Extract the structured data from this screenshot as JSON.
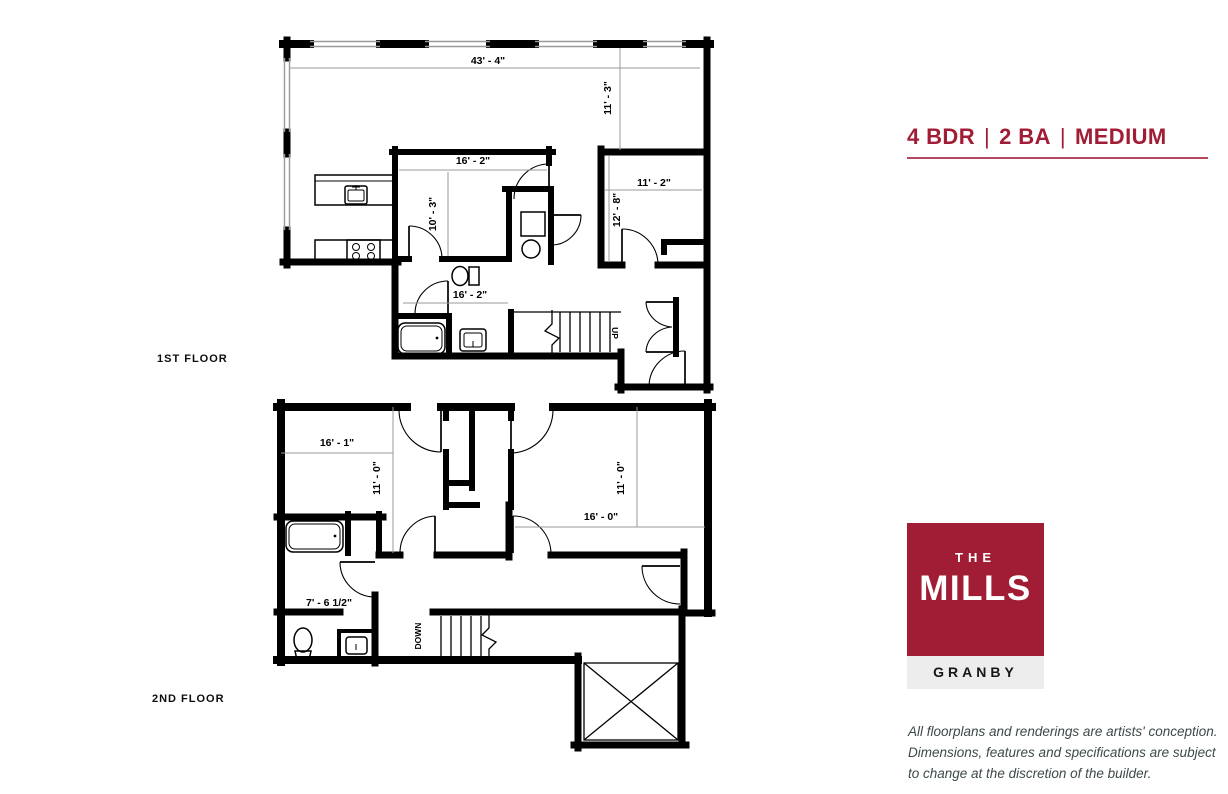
{
  "header": {
    "bedrooms": "4 BDR",
    "separator": "|",
    "baths": "2 BA",
    "size": "MEDIUM"
  },
  "floor_labels": {
    "first": "1ST FLOOR",
    "second": "2ND FLOOR"
  },
  "dims": {
    "f1": {
      "overall_width": "43' - 4\"",
      "living_depth": "11' - 3\"",
      "bedroom1_width": "16' - 2\"",
      "bedroom1_depth": "10' - 3\"",
      "bedroom2_width": "11' - 2\"",
      "bedroom2_depth": "12' - 8\"",
      "bath_width": "16' - 2\""
    },
    "f2": {
      "bedroom3_width": "16' - 1\"",
      "bedroom3_depth": "11' - 0\"",
      "bedroom4_depth": "11' - 0\"",
      "bedroom4_width": "16' - 0\"",
      "bath_width": "7' - 6 1/2\""
    }
  },
  "stairs": {
    "up": "UP",
    "down": "DOWN"
  },
  "logo": {
    "the": "THE",
    "mills": "MILLS",
    "location": "GRANBY"
  },
  "disclaimer": {
    "line1": "All floorplans and renderings are artists' conception.",
    "line2": "Dimensions, features and specifications are subject",
    "line3": "to change at the discretion of the builder."
  },
  "colors": {
    "brand": "#A01D35",
    "underline": "#B4485F",
    "plan_line": "#000000",
    "dimension_line": "#9A9A9A",
    "granby_bg": "#EDEDED",
    "disclaimer_text": "#3D4A4A"
  }
}
